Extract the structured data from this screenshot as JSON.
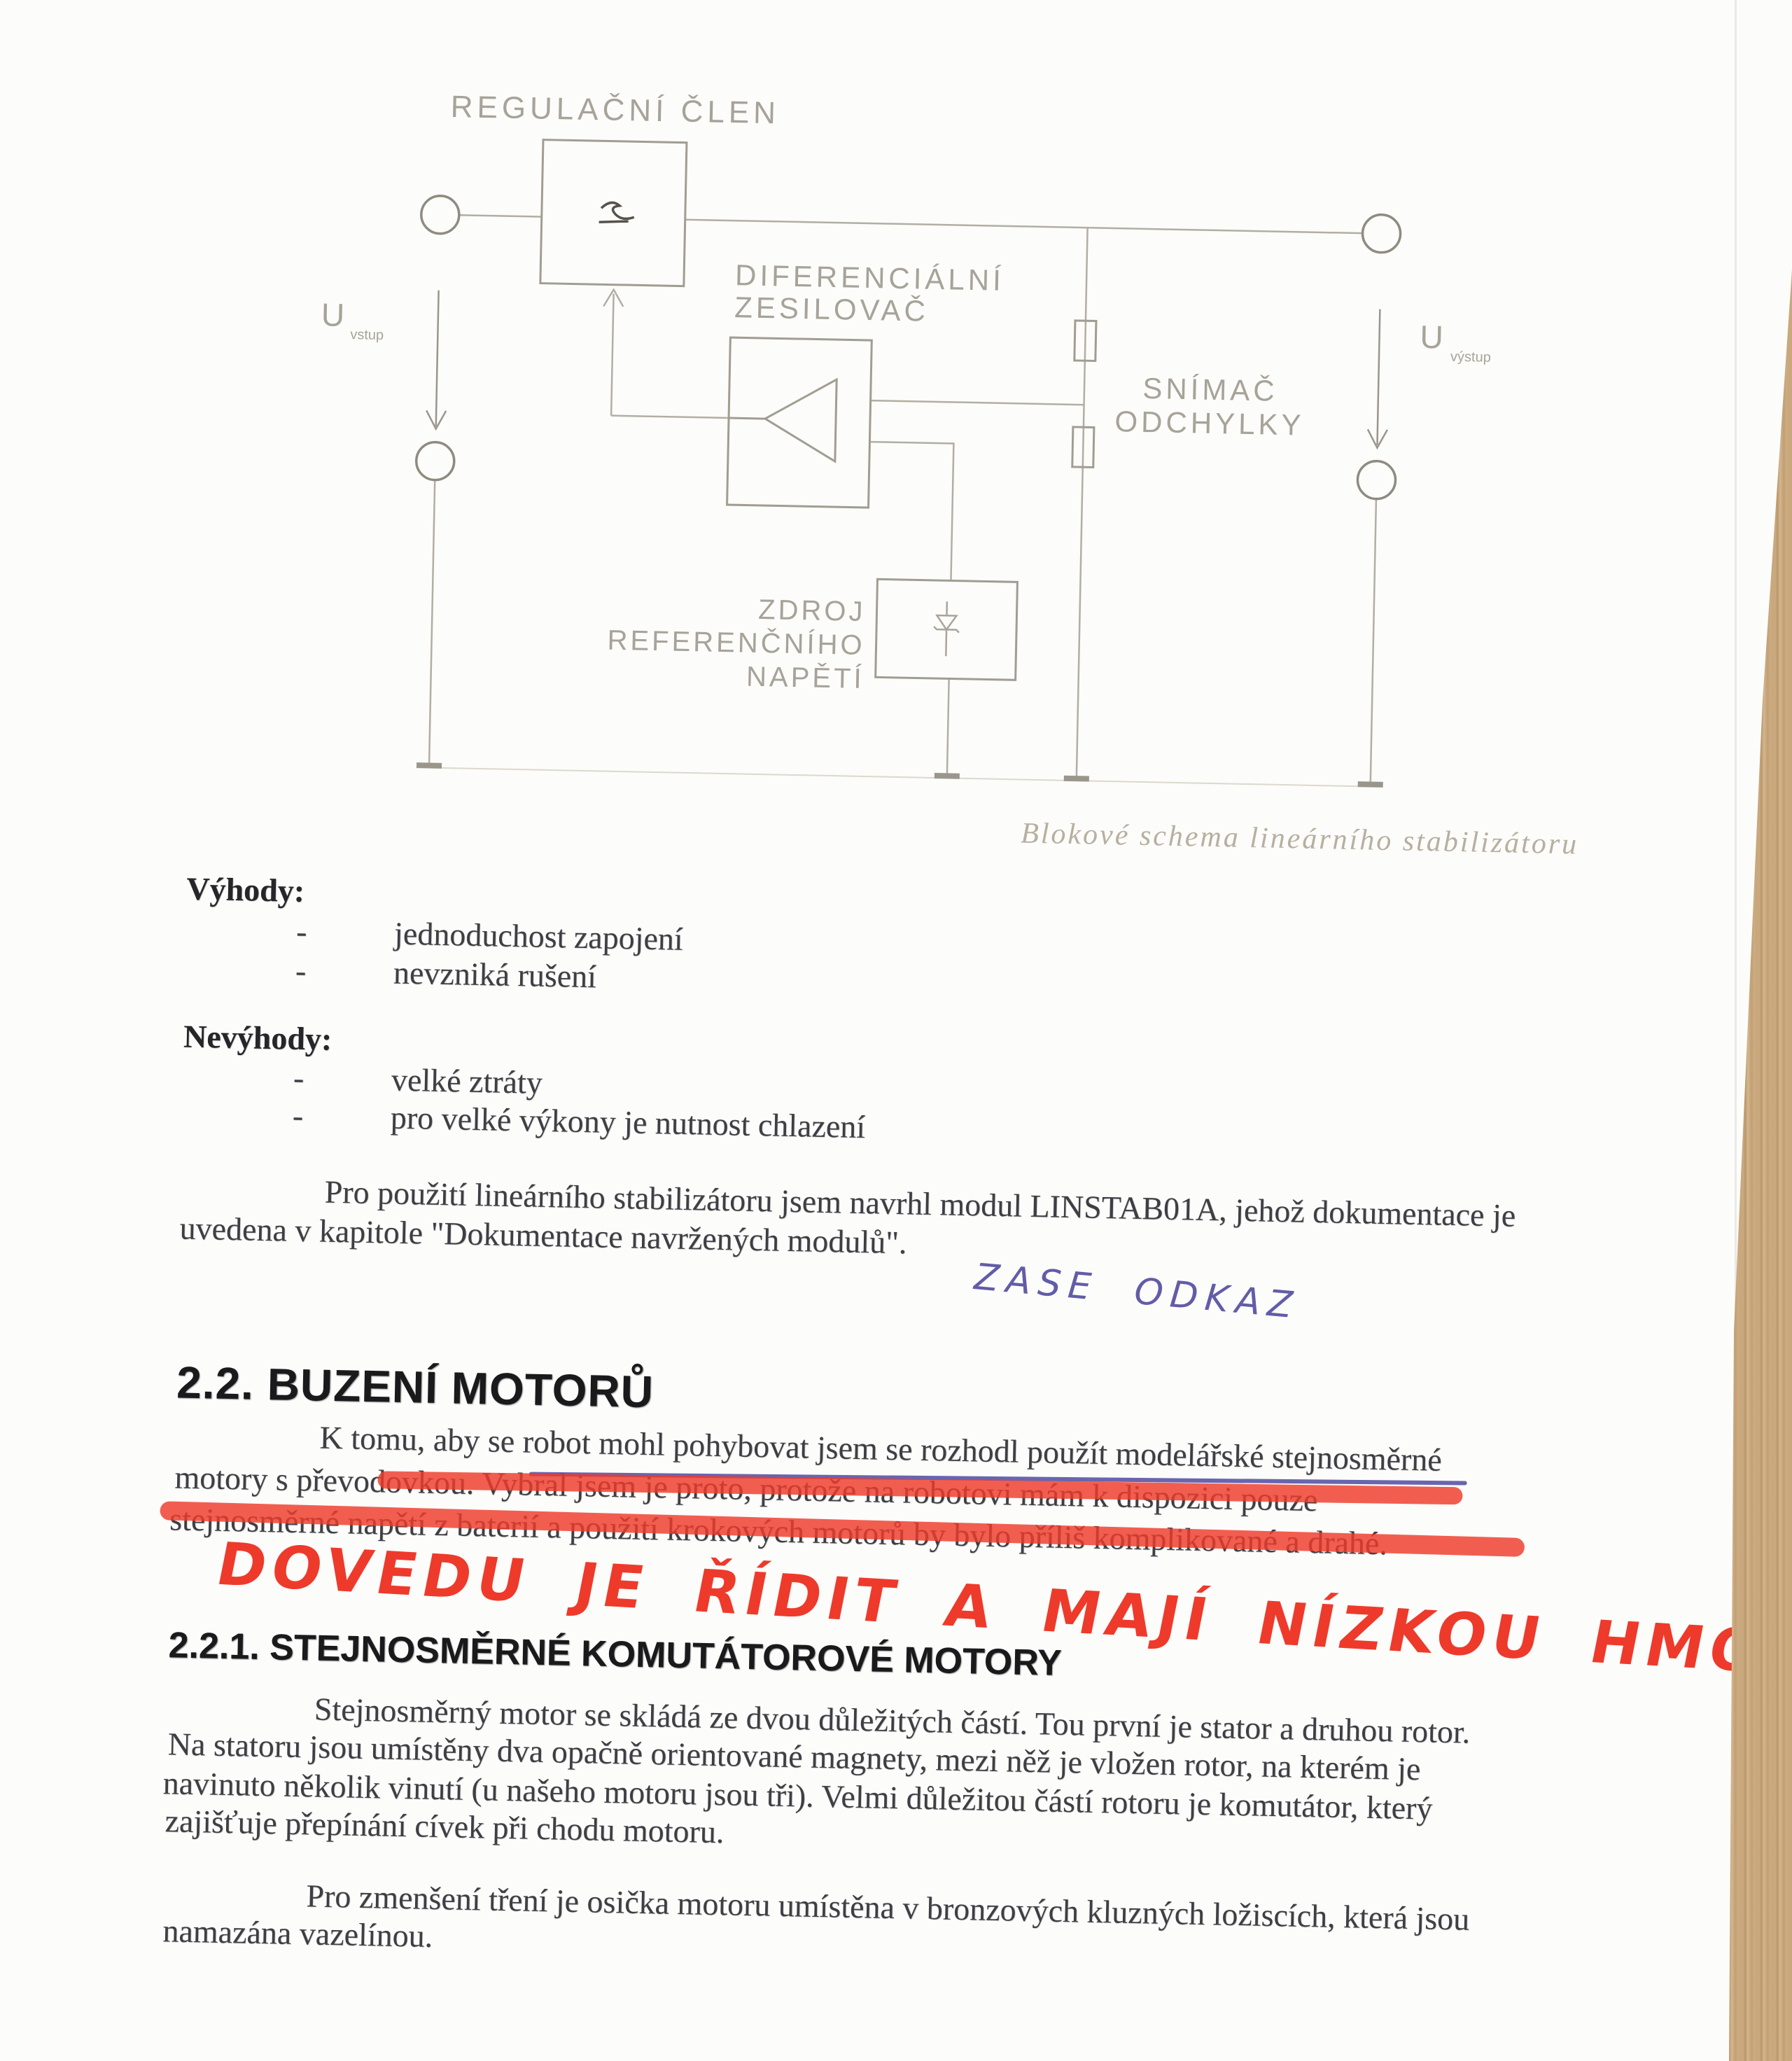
{
  "document": {
    "diagram": {
      "regulator_label": "REGULAČNÍ ČLEN",
      "amp_label_1": "DIFERENCIÁLNÍ",
      "amp_label_2": "ZESILOVAČ",
      "sensor_label_1": "SNÍMAČ",
      "sensor_label_2": "ODCHYLKY",
      "ref_label_1": "ZDROJ",
      "ref_label_2": "REFERENČNÍHO",
      "ref_label_3": "NAPĚTÍ",
      "u_in": "U",
      "u_in_sub": "vstup",
      "u_out": "U",
      "u_out_sub": "výstup",
      "caption": "Blokové schema lineárního stabilizátoru"
    },
    "lists": {
      "bullet_char": "-",
      "advantages_title": "Výhody:",
      "advantages": [
        "jednoduchost zapojení",
        "nevzniká rušení"
      ],
      "disadvantages_title": "Nevýhody:",
      "disadvantages": [
        "velké ztráty",
        "pro velké výkony je nutnost chlazení"
      ]
    },
    "paragraph_linstab": [
      "Pro použití lineárního stabilizátoru jsem navrhl modul LINSTAB01A, jehož dokumentace je",
      "uvedena v kapitole \"Dokumentace navržených modulů\"."
    ],
    "handwriting": {
      "blue_note": "ZASE ODKAZ",
      "red_note": "DOVEDU JE ŘÍDIT A MAJÍ NÍZKOU HMOTNOST"
    },
    "section_motors": {
      "heading": "2.2. BUZENÍ MOTORŮ",
      "paragraph": [
        "K tomu, aby se robot mohl pohybovat jsem se rozhodl použít modelářské stejnosměrné",
        "motory s převodovkou. Vybral jsem je proto, protože na robotovi mám k dispozici pouze",
        "stejnosměrné napětí z baterií a použití krokových motorů by bylo příliš komplikované a drahé."
      ]
    },
    "section_dc_motors": {
      "heading": "2.2.1. STEJNOSMĚRNÉ KOMUTÁTOROVÉ MOTORY",
      "paragraph_1": [
        "Stejnosměrný motor se skládá ze dvou důležitých částí. Tou první je stator a druhou rotor.",
        "Na statoru jsou umístěny dva opačně orientované magnety, mezi něž je vložen rotor, na kterém je",
        "navinuto několik vinutí (u našeho motoru jsou tři). Velmi důležitou částí rotoru je komutátor, který",
        "zajišťuje přepínání cívek při chodu motoru."
      ],
      "paragraph_2": [
        "Pro zmenšení tření je osička motoru umístěna v bronzových kluzných ložiscích, která jsou",
        "namazána vazelínou."
      ]
    },
    "colors": {
      "red_marker": "#ee3a2b",
      "blue_pen": "#514a9e",
      "diagram_gray": "#a9a59b",
      "wood": "#c9a87e"
    }
  }
}
